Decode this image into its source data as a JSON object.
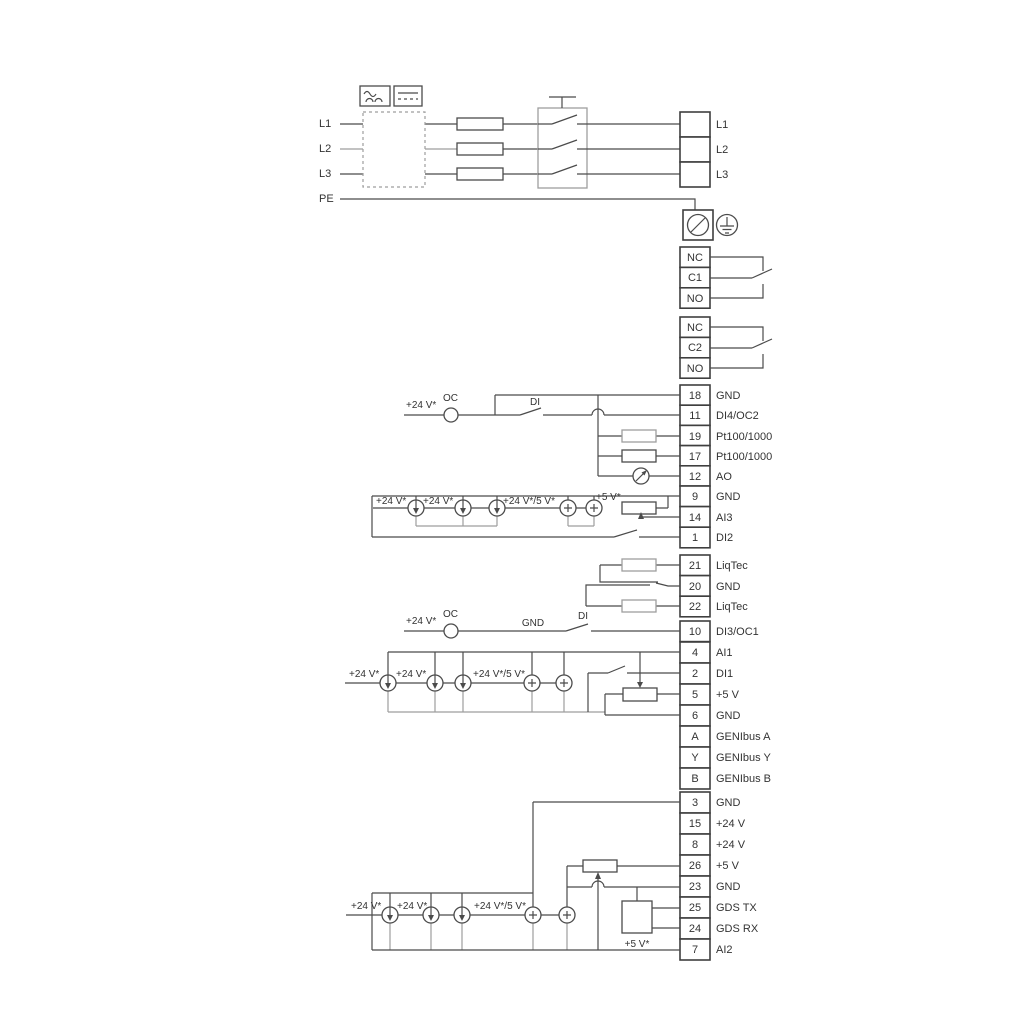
{
  "title": "Wiring diagram",
  "labels": {
    "v24": "+24 V*",
    "v24_5": "+24 V*/5 V*",
    "v5": "+5 V*",
    "oc": "OC",
    "di": "DI",
    "gnd": "GND"
  },
  "power": {
    "inputs": [
      "L1",
      "L2",
      "L3",
      "PE"
    ],
    "outputs": [
      "L1",
      "L2",
      "L3"
    ]
  },
  "relays": {
    "r1": [
      "NC",
      "C1",
      "NO"
    ],
    "r2": [
      "NC",
      "C2",
      "NO"
    ]
  },
  "terminals": {
    "g1": [
      {
        "n": "18",
        "label": "GND"
      },
      {
        "n": "11",
        "label": "DI4/OC2"
      },
      {
        "n": "19",
        "label": "Pt100/1000"
      },
      {
        "n": "17",
        "label": "Pt100/1000"
      },
      {
        "n": "12",
        "label": "AO"
      }
    ],
    "g2": [
      {
        "n": "9",
        "label": "GND"
      },
      {
        "n": "14",
        "label": "AI3"
      },
      {
        "n": "1",
        "label": "DI2"
      }
    ],
    "g3": [
      {
        "n": "21",
        "label": "LiqTec"
      },
      {
        "n": "20",
        "label": "GND"
      },
      {
        "n": "22",
        "label": "LiqTec"
      }
    ],
    "g4": [
      {
        "n": "10",
        "label": "DI3/OC1"
      }
    ],
    "g5": [
      {
        "n": "4",
        "label": "AI1"
      },
      {
        "n": "2",
        "label": "DI1"
      },
      {
        "n": "5",
        "label": "+5 V"
      },
      {
        "n": "6",
        "label": "GND"
      },
      {
        "n": "A",
        "label": "GENIbus A"
      },
      {
        "n": "Y",
        "label": "GENIbus Y"
      },
      {
        "n": "B",
        "label": "GENIbus B"
      }
    ],
    "g6": [
      {
        "n": "3",
        "label": "GND"
      },
      {
        "n": "15",
        "label": "+24 V"
      },
      {
        "n": "8",
        "label": "+24 V"
      },
      {
        "n": "26",
        "label": "+5 V"
      },
      {
        "n": "23",
        "label": "GND"
      },
      {
        "n": "25",
        "label": "GDS TX"
      },
      {
        "n": "24",
        "label": "GDS RX"
      },
      {
        "n": "7",
        "label": "AI2"
      }
    ]
  },
  "colors": {
    "wire": "#4b4b4b",
    "wire_gray": "#9e9e9e",
    "text": "#333333",
    "background": "#ffffff"
  }
}
